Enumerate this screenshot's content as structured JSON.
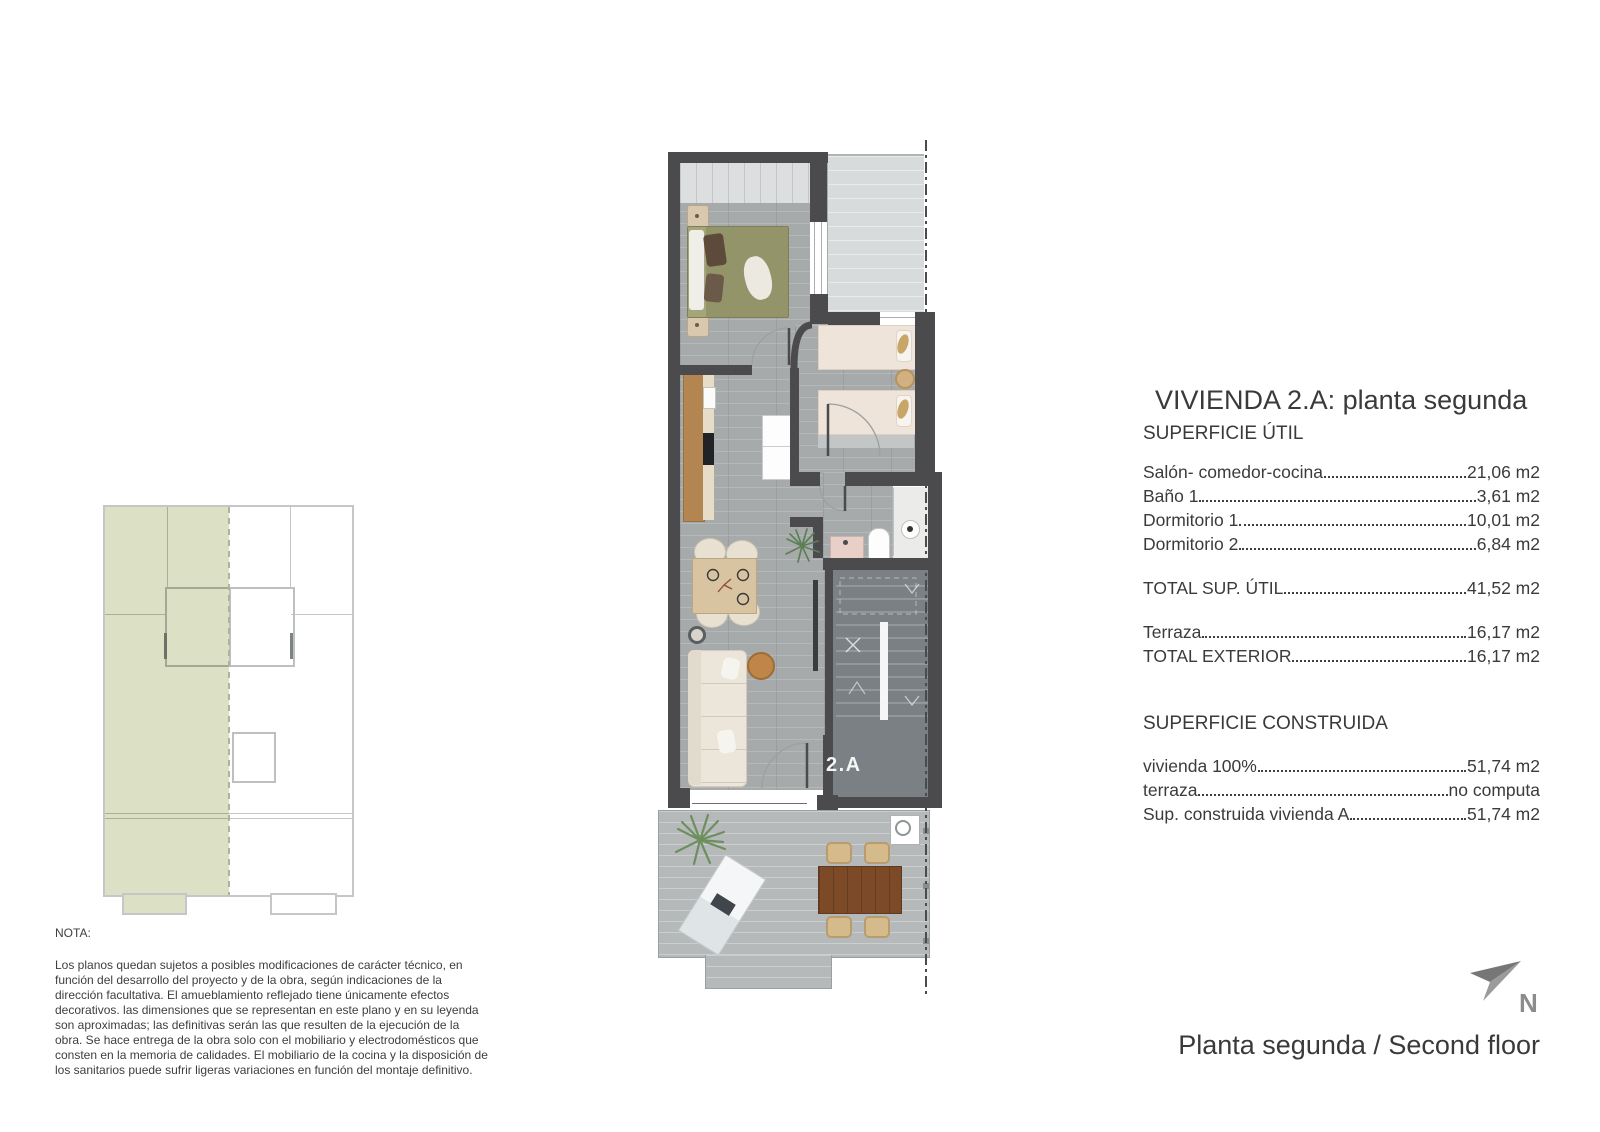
{
  "document": {
    "title": "VIVIENDA 2.A: planta segunda",
    "footer_title": "Planta segunda / Second floor",
    "north_label": "N",
    "unit_label": "2.A"
  },
  "superficie_util": {
    "heading": "SUPERFICIE ÚTIL",
    "rows": [
      {
        "label": "Salón- comedor-cocina",
        "value": "21,06 m2"
      },
      {
        "label": "Baño 1",
        "value": "3,61 m2"
      },
      {
        "label": "Dormitorio 1",
        "value": "10,01 m2"
      },
      {
        "label": "Dormitorio 2",
        "value": "6,84 m2"
      }
    ],
    "total": {
      "label": "TOTAL SUP. ÚTIL",
      "value": "41,52 m2"
    },
    "exterior": [
      {
        "label": "Terraza",
        "value": "16,17 m2"
      },
      {
        "label": "TOTAL EXTERIOR",
        "value": "16,17 m2"
      }
    ]
  },
  "superficie_construida": {
    "heading": "SUPERFICIE CONSTRUIDA",
    "rows": [
      {
        "label": "vivienda 100%",
        "value": "51,74 m2"
      },
      {
        "label": "terraza",
        "value": "no computa"
      },
      {
        "label": "Sup. construida vivienda A",
        "value": "51,74 m2"
      }
    ]
  },
  "nota": {
    "heading": "NOTA:",
    "body": "Los planos quedan sujetos a posibles modificaciones de carácter técnico, en función del desarrollo del proyecto y de la obra, según indicaciones de la dirección facultativa. El amueblamiento reflejado tiene únicamente efectos decorativos. las dimensiones que se representan en este plano y en su leyenda son aproximadas; las definitivas serán las que resulten de la ejecución de la obra. Se hace entrega de la obra solo con el mobiliario y electrodomésticos que consten en la memoria de calidades. El mobiliario de la cocina y la disposición de los sanitarios puede sufrir ligeras variaciones en función del montaje definitivo."
  },
  "colors": {
    "wall": "#4b4b4d",
    "unit_highlight": "#dce1c6",
    "north_arrow": "#8f8f8f",
    "stair_floor": "#7b8084"
  }
}
